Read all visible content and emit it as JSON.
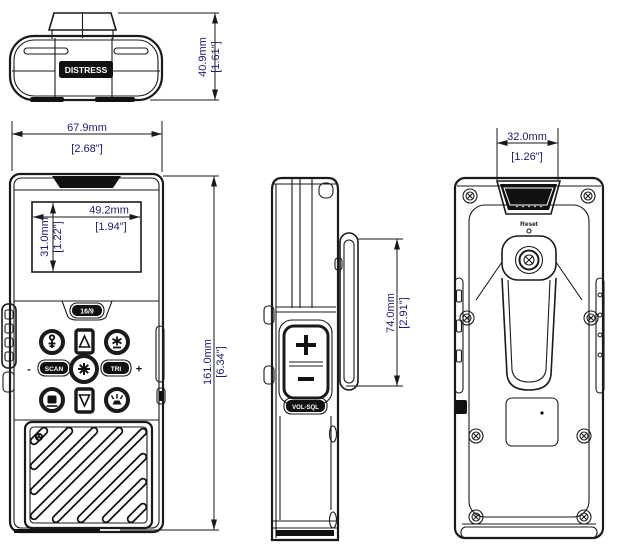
{
  "document": {
    "type": "technical-dimension-drawing",
    "subject": "Handheld VHF marine radio - top, front, side and rear views",
    "units": "mm [inches]"
  },
  "colors": {
    "background": "#ffffff",
    "line": "#1a1a1a",
    "dimension_text": "#1c1c6e",
    "dark_fill": "#111111"
  },
  "top_view": {
    "distress_label": "DISTRESS",
    "depth_dim_mm": "40.9mm",
    "depth_dim_in": "[1.61\"]"
  },
  "front_view": {
    "width_dim_mm": "67.9mm",
    "width_dim_in": "[2.68\"]",
    "lcd_width_dim_mm": "49.2mm",
    "lcd_width_dim_in": "[1.94\"]",
    "lcd_height_dim_mm": "31.0mm",
    "lcd_height_dim_in": "[1.22\"]",
    "height_dim_mm": "161.0mm",
    "height_dim_in": "[6.34\"]",
    "key_16_9": "16/9",
    "key_scan": "SCAN",
    "key_tri": "TRI",
    "volume_minus": "-",
    "volume_plus": "+"
  },
  "side_view": {
    "clip_dim_mm": "74.0mm",
    "clip_dim_in": "[2.91\"]",
    "vol_sql_label": "VOL-SQL"
  },
  "back_view": {
    "width_dim_mm": "32.0mm",
    "width_dim_in": "[1.26\"]",
    "reset_label": "Reset"
  },
  "icons": {
    "keypad_top_left": "key-icon",
    "keypad_top_right": "backlight-icon",
    "keypad_up": "up-arrow-icon",
    "keypad_down": "down-arrow-icon",
    "keypad_center": "power-lock-icon",
    "keypad_bottom_left": "memory-icon",
    "keypad_bottom_right": "strobe-icon",
    "speaker_area": "speaker-grille",
    "mic_hole": "microphone-icon"
  }
}
